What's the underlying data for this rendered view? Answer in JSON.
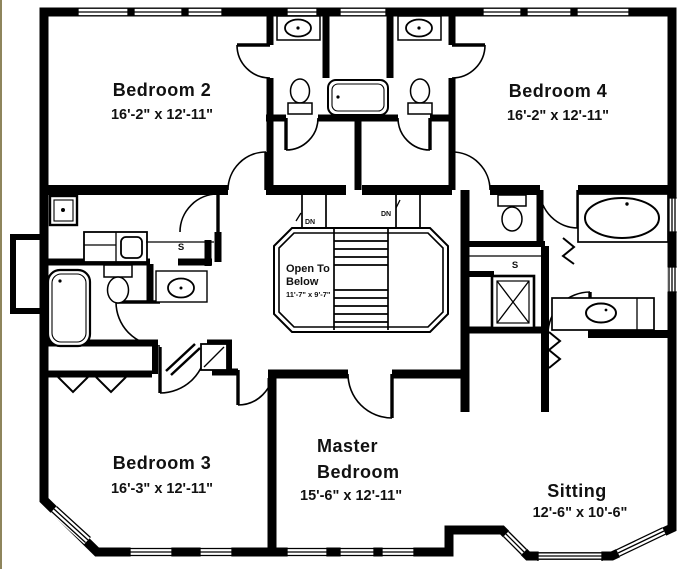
{
  "plan": {
    "rooms": {
      "bedroom2": {
        "name": "Bedroom 2",
        "dims": "16'-2\" x 12'-11\""
      },
      "bedroom4": {
        "name": "Bedroom 4",
        "dims": "16'-2\" x 12'-11\""
      },
      "bedroom3": {
        "name": "Bedroom 3",
        "dims": "16'-3\" x 12'-11\""
      },
      "master": {
        "name_line1": "Master",
        "name_line2": "Bedroom",
        "dims": "15'-6\" x 12'-11\""
      },
      "sitting": {
        "name": "Sitting",
        "dims": "12'-6\" x 10'-6\""
      },
      "open_to_below": {
        "line1": "Open To",
        "line2": "Below",
        "dims": "11'-7\" x 9'-7\""
      }
    },
    "labels": {
      "stairs_down": "DN",
      "shelf": "S"
    },
    "colors": {
      "wall": "#000000",
      "floor": "#ffffff",
      "edge_stripe": "#8e855c",
      "text": "#111111"
    }
  }
}
